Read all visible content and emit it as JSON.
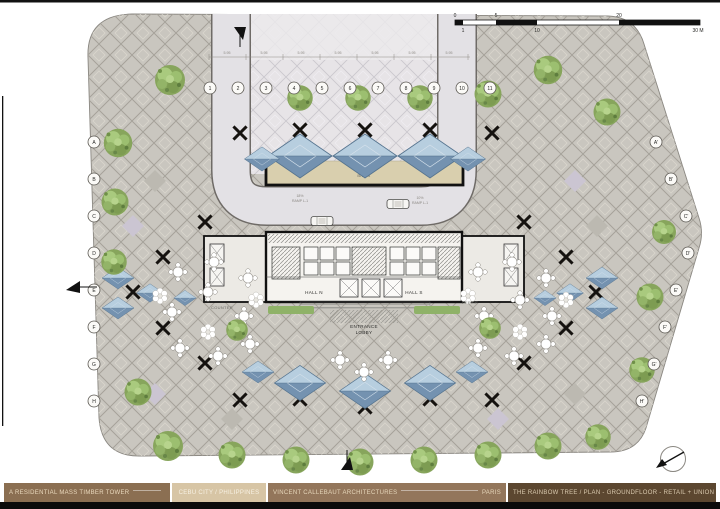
{
  "plan": {
    "rooms": {
      "bikes": "BIKES",
      "hall_n": "HALL N",
      "hall_s": "HALL S",
      "entrance_l1": "ENTRANCE",
      "entrance_l2": "LOBBY",
      "office": "OFFICE",
      "counter": "COUNTER"
    },
    "ramps": {
      "left_l1": "18%",
      "left_l2": "RAMP L-1",
      "right_l1": "10%",
      "right_l2": "RAMP L-1"
    },
    "grid": {
      "top": [
        "1",
        "2",
        "3",
        "4",
        "5",
        "6",
        "7",
        "8",
        "9",
        "10",
        "11"
      ],
      "left": [
        "A",
        "B",
        "C",
        "D",
        "E",
        "F",
        "G",
        "H"
      ],
      "right": [
        "A'",
        "B'",
        "C'",
        "D'",
        "E'",
        "F'",
        "G'",
        "H'"
      ]
    },
    "dims": [
      "5.95",
      "5.95",
      "5.95",
      "5.95",
      "5.95",
      "5.95",
      "5.95"
    ]
  },
  "scalebar": {
    "top": [
      "0",
      "5",
      "20"
    ],
    "bottom": [
      "1",
      "10",
      "30 M"
    ]
  },
  "titlebar": {
    "project": "A RESIDENTIAL MASS TIMBER TOWER",
    "location": "CEBU CITY / PHILIPPINES",
    "firm": "VINCENT CALLEBAUT ARCHITECTURES",
    "city": "PARIS",
    "sheet": "THE RAINBOW TREE / PLAN - GROUNDFLOOR - RETAIL + UNION BANK"
  },
  "colors": {
    "paving": "#c9c6bf",
    "road": "#e3e1e5",
    "water_light": "#b7cedf",
    "water_dark": "#7492b0",
    "tree_green": "#87a55c",
    "bar_brown_1": "#8b6f52",
    "bar_tan": "#d7c5a5",
    "bar_brown_2": "#93765b",
    "bar_dark": "#5c4730"
  }
}
